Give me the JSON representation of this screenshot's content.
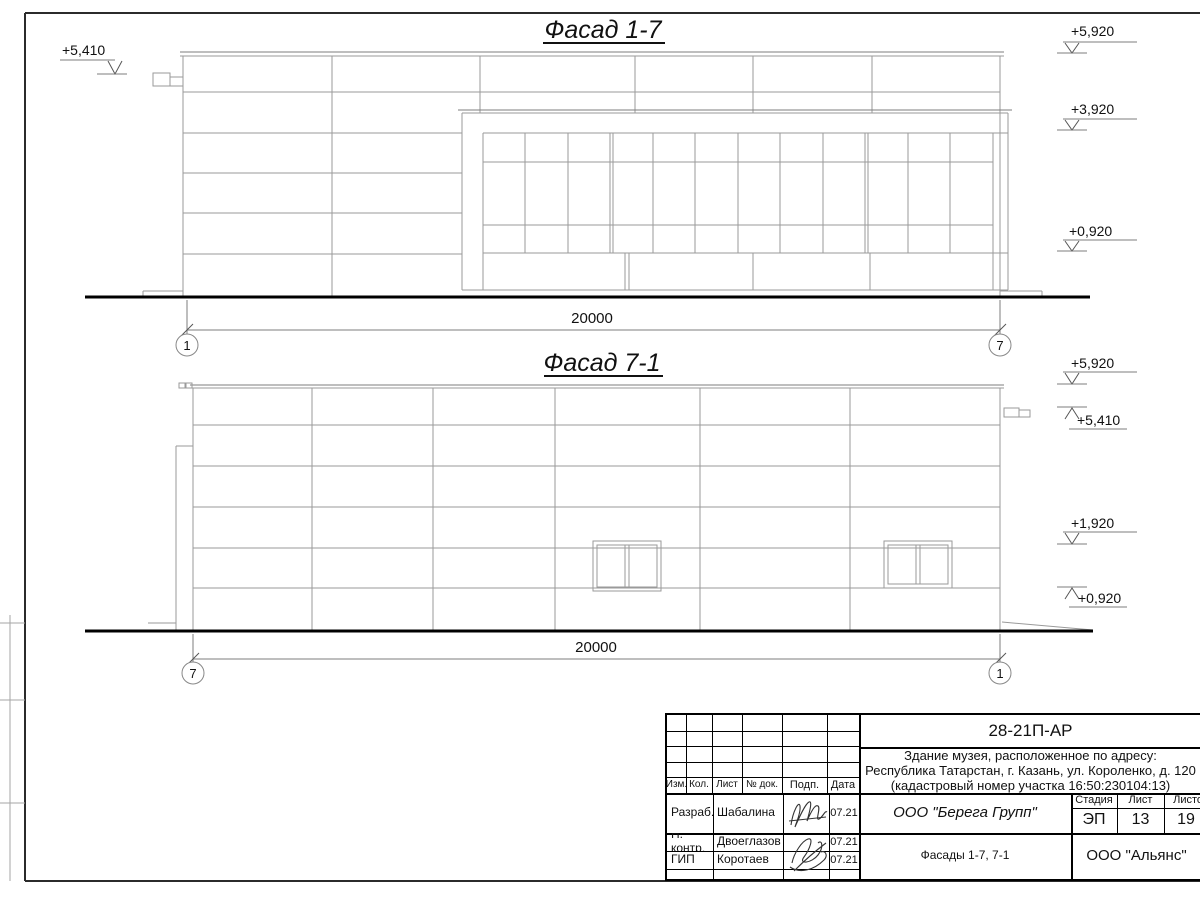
{
  "facade17": {
    "title": "Фасад 1-7",
    "mark_left": "+5,410",
    "mark_r1": "+5,920",
    "mark_r2": "+3,920",
    "mark_r3": "+0,920",
    "dimension": "20000",
    "axis_left": "1",
    "axis_right": "7"
  },
  "facade71": {
    "title": "Фасад 7-1",
    "mark_r1": "+5,920",
    "mark_r2": "+5,410",
    "mark_r3": "+1,920",
    "mark_r4": "+0,920",
    "dimension": "20000",
    "axis_left": "7",
    "axis_right": "1"
  },
  "sheet": {
    "doc_number": "28-21П-АР",
    "project_line1": "Здание музея, расположенное по адресу:",
    "project_line2": "Республика Татарстан, г. Казань, ул. Короленко, д. 120",
    "project_line3": "(кадастровый номер участка 16:50:230104:13)",
    "columns": {
      "izm": "Изм.",
      "kol": "Кол.",
      "list": "Лист",
      "ndok": "№ док.",
      "podp": "Подп.",
      "data": "Дата"
    },
    "signers": [
      {
        "role": "Разраб.",
        "name": "Шабалина",
        "date": "07.21"
      },
      {
        "role": "Н. контр.",
        "name": "Двоеглазов",
        "date": "07.21"
      },
      {
        "role": "ГИП",
        "name": "Коротаев",
        "date": "07.21"
      }
    ],
    "company": "ООО \"Берега Групп\"",
    "stage_label": "Стадия",
    "sheet_label": "Лист",
    "sheets_label": "Листов",
    "stage": "ЭП",
    "sheet_num": "13",
    "sheets_total": "19",
    "sheet_title": "Фасады 1-7, 7-1",
    "org": "ООО \"Альянс\""
  },
  "colors": {
    "hairline": "#9a9a9a",
    "medium": "#777777",
    "ink": "#111111"
  }
}
